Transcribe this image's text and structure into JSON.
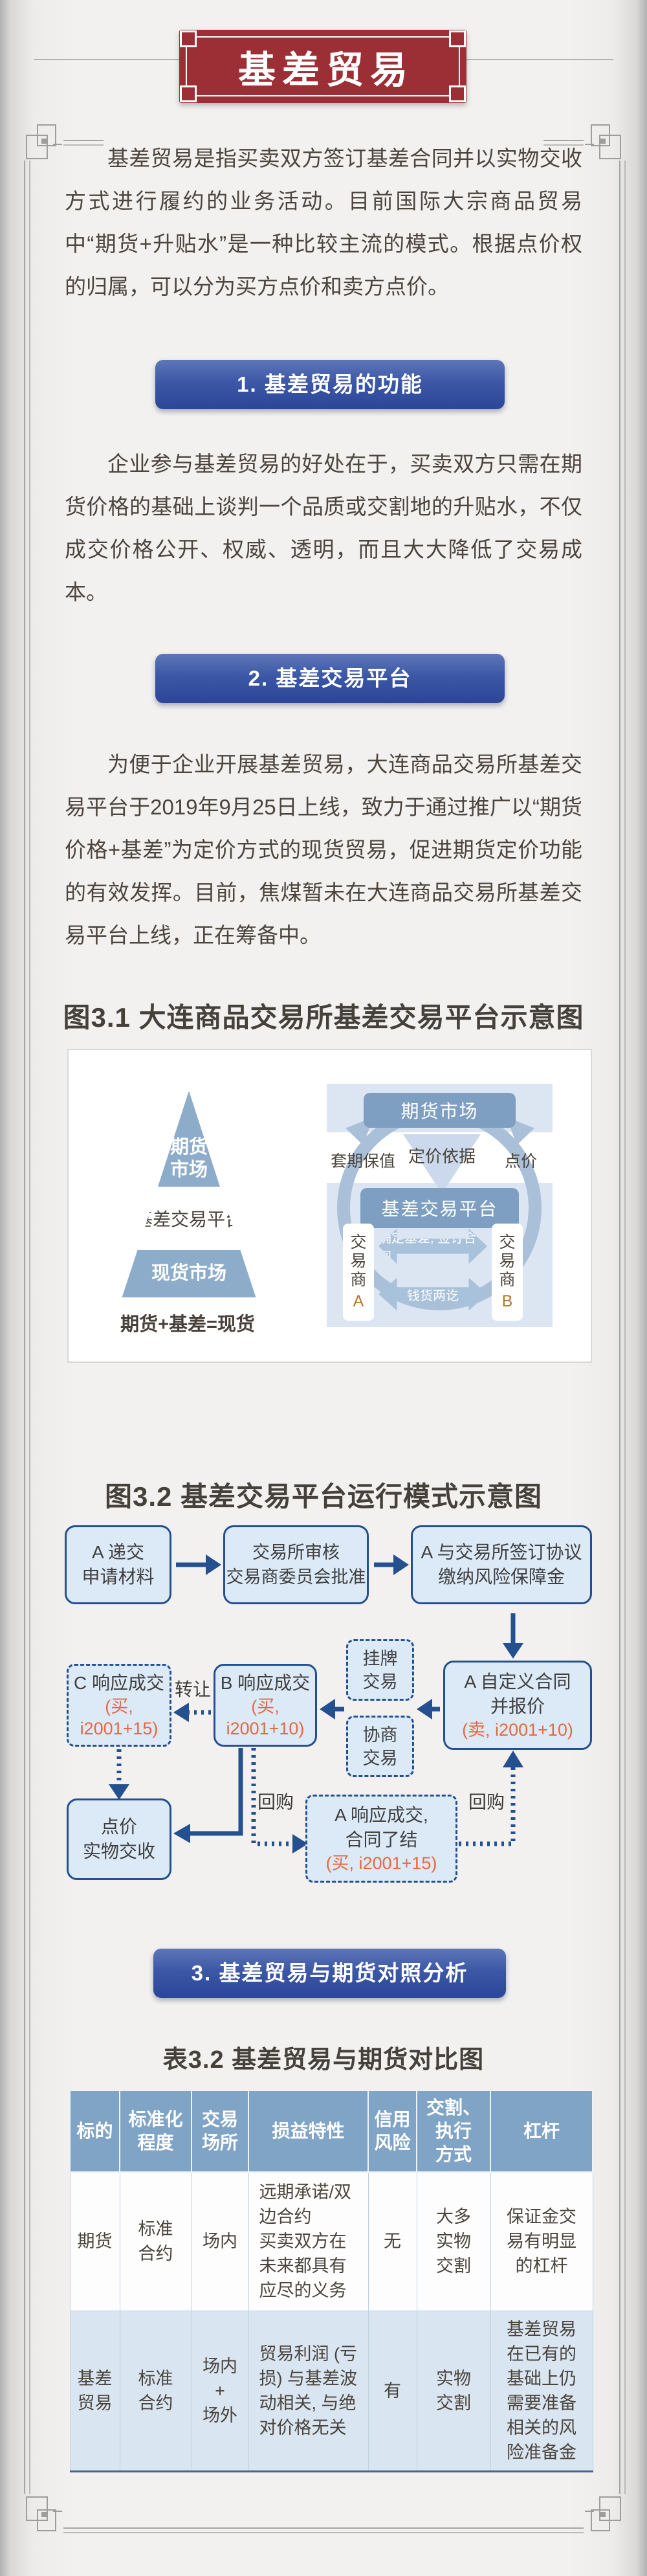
{
  "colors": {
    "banner_red": "#9c2f36",
    "section_bar_blue": "#2b4697",
    "flow_navy": "#24508f",
    "flow_fill": "#dce9f7",
    "highlight_orange": "#e8673e",
    "diagram_blue": "#8cacca",
    "diagram_box_blue": "#7e9fc1",
    "diagram_panel_blue": "#dce6f2",
    "table_header_blue": "#80a4c6",
    "table_row_blue": "#d9e5f1"
  },
  "banner": {
    "title": "基差贸易"
  },
  "intro": {
    "text": "基差贸易是指买卖双方签订基差合同并以实物交收方式进行履约的业务活动。目前国际大宗商品贸易中“期货+升贴水”是一种比较主流的模式。根据点价权的归属，可以分为买方点价和卖方点价。"
  },
  "sections": [
    {
      "header": "1. 基差贸易的功能",
      "body": "企业参与基差贸易的好处在于，买卖双方只需在期货价格的基础上谈判一个品质或交割地的升贴水，不仅成交价格公开、权威、透明，而且大大降低了交易成本。"
    },
    {
      "header": "2. 基差交易平台",
      "body": "为便于企业开展基差贸易，大连商品交易所基差交易平台于2019年9月25日上线，致力于通过推广以“期货价格+基差”为定价方式的现货贸易，促进期货定价功能的有效发挥。目前，焦煤暂未在大连商品交易所基差交易平台上线，正在筹备中。"
    },
    {
      "header": "3. 基差贸易与期货对照分析"
    }
  ],
  "figure31": {
    "title": "图3.1 大连商品交易所基差交易平台示意图",
    "pyramid": {
      "top": "期货\n市场",
      "middle": "基差交易平台",
      "bottom": "现货市场",
      "caption": "期货+基差=现货"
    },
    "cycle": {
      "top_box": "期货市场",
      "left_label": "套期保值",
      "center_label": "定价依据",
      "right_label": "点价",
      "mid_box": "基差交易平台",
      "trader_a_label": "交易商",
      "trader_a_letter": "A",
      "trader_b_label": "交易商",
      "trader_b_letter": "B",
      "arrow_top": "确定基差, 签订合同",
      "arrow_bottom": "钱货两讫"
    }
  },
  "figure32": {
    "title": "图3.2 基差交易平台运行模式示意图",
    "apply": "A 递交\n申请材料",
    "review": "交易所审核\n交易商委员会批准",
    "sign": "A 与交易所签订协议\n缴纳风险保障金",
    "quote": "A 自定义合同\n并报价",
    "quote_note": "(卖, i2001+10)",
    "listing": "挂牌\n交易",
    "negotiate": "协商\n交易",
    "b_deal": "B 响应成交",
    "b_note": "(买, i2001+10)",
    "c_deal": "C 响应成交",
    "c_note": "(买, i2001+15)",
    "transfer": "转让",
    "delivery": "点价\n实物交收",
    "a_deal": "A 响应成交,\n合同了结",
    "a_note": "(买, i2001+15)",
    "buyback_left": "回购",
    "buyback_right": "回购"
  },
  "table32": {
    "title": "表3.2 基差贸易与期货对比图",
    "headers": [
      "标的",
      "标准化\n程度",
      "交易\n场所",
      "损益特性",
      "信用\n风险",
      "交割、\n执行\n方式",
      "杠杆"
    ],
    "rows": [
      [
        "期货",
        "标准\n合约",
        "场内",
        "远期承诺/双边合约\n买卖双方在未来都具有应尽的义务",
        "无",
        "大多\n实物\n交割",
        "保证金交易有明显的杠杆"
      ],
      [
        "基差\n贸易",
        "标准\n合约",
        "场内\n+\n场外",
        "贸易利润 (亏损) 与基差波动相关, 与绝对价格无关",
        "有",
        "实物\n交割",
        "基差贸易在已有的基础上仍需要准备相关的风险准备金"
      ]
    ]
  }
}
